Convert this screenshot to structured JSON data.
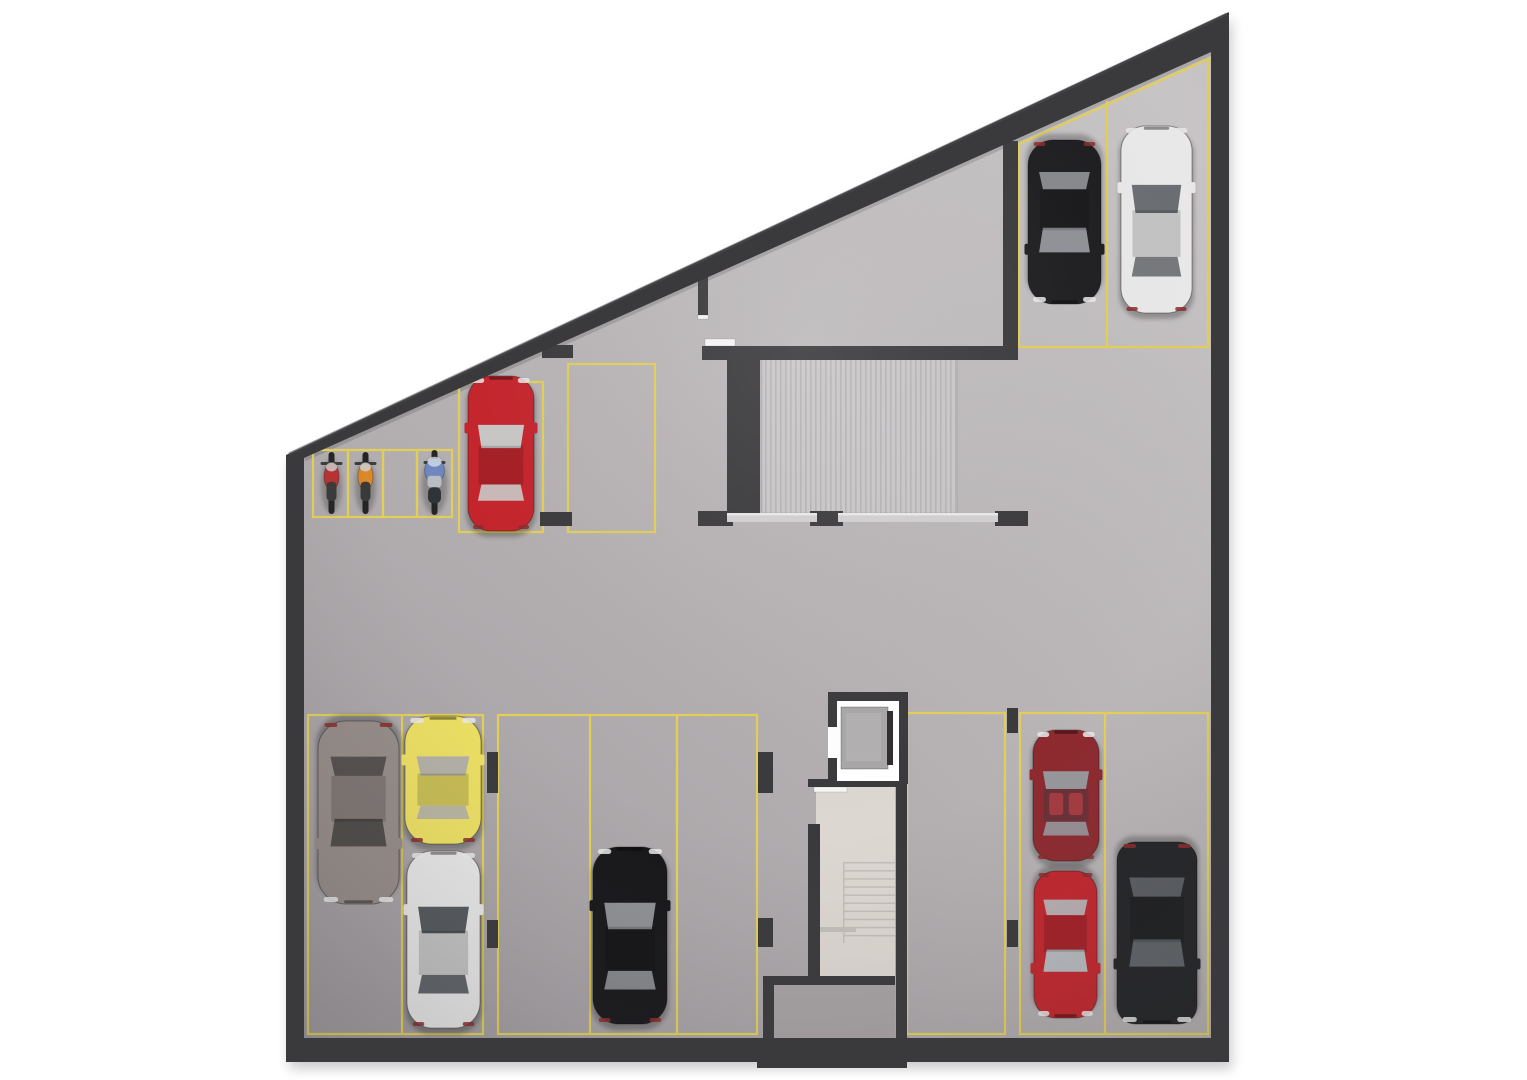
{
  "canvas": {
    "width": 1527,
    "height": 1080,
    "background": "#ffffff"
  },
  "palette": {
    "wall": "#3a3a3c",
    "wall_light": "#4b4b4d",
    "floor_light": "#c7c4c5",
    "floor_mid": "#b6b2b4",
    "floor_dark": "#a19da0",
    "stall_line": "#e3cf55",
    "ramp_base": "#c9c7c8",
    "ramp_stripe": "#b5b3b4",
    "stair_floor": "#dcd7d1",
    "stair_tread": "#c3beb8",
    "vestibule_floor": "#a7a3a5",
    "rail": "#d2d0d1",
    "rail_highlight": "#ebe9ea",
    "door": "#f5f5f5",
    "elevator_shaft": "#ffffff",
    "elevator_car": "#a9a7a7",
    "shadow": "#000000"
  },
  "building": {
    "outer": [
      [
        286,
        455
      ],
      [
        1229,
        12
      ],
      [
        1229,
        1062
      ],
      [
        286,
        1062
      ]
    ],
    "inner": [
      [
        304,
        458
      ],
      [
        1211,
        52
      ],
      [
        1211,
        1038
      ],
      [
        304,
        1038
      ]
    ]
  },
  "interior_walls": [
    {
      "name": "diagonal-stub",
      "x": 698,
      "y": 277,
      "w": 10,
      "h": 38
    },
    {
      "name": "ramp-north-wall",
      "x": 702,
      "y": 346,
      "w": 316,
      "h": 14
    },
    {
      "name": "ramp-west-wall",
      "x": 727,
      "y": 355,
      "w": 33,
      "h": 160
    },
    {
      "name": "ramp-east-wall",
      "x": 1003,
      "y": 141,
      "w": 15,
      "h": 219
    },
    {
      "name": "stall-stub-north",
      "x": 542,
      "y": 345,
      "w": 31,
      "h": 13
    },
    {
      "name": "stall-stub-south",
      "x": 540,
      "y": 512,
      "w": 32,
      "h": 14
    },
    {
      "name": "rail-post-west",
      "x": 698,
      "y": 511,
      "w": 35,
      "h": 15
    },
    {
      "name": "rail-post-mid",
      "x": 810,
      "y": 511,
      "w": 33,
      "h": 15
    },
    {
      "name": "rail-post-east",
      "x": 995,
      "y": 511,
      "w": 33,
      "h": 15
    },
    {
      "name": "pillar-a1",
      "x": 487,
      "y": 752,
      "w": 11,
      "h": 41
    },
    {
      "name": "pillar-a2",
      "x": 487,
      "y": 920,
      "w": 11,
      "h": 28
    },
    {
      "name": "pillar-b1",
      "x": 758,
      "y": 752,
      "w": 15,
      "h": 41
    },
    {
      "name": "pillar-b2",
      "x": 758,
      "y": 918,
      "w": 15,
      "h": 29
    },
    {
      "name": "pillar-c1",
      "x": 1007,
      "y": 708,
      "w": 11,
      "h": 25
    },
    {
      "name": "pillar-c2",
      "x": 1007,
      "y": 920,
      "w": 11,
      "h": 27
    },
    {
      "name": "stair-north-wall",
      "x": 808,
      "y": 779,
      "w": 99,
      "h": 8
    },
    {
      "name": "stair-west-wall",
      "x": 808,
      "y": 824,
      "w": 12,
      "h": 154
    },
    {
      "name": "stair-east-wall",
      "x": 896,
      "y": 782,
      "w": 11,
      "h": 256
    },
    {
      "name": "vestibule-north-wall",
      "x": 763,
      "y": 976,
      "w": 132,
      "h": 9
    },
    {
      "name": "vestibule-west-wall",
      "x": 763,
      "y": 976,
      "w": 11,
      "h": 62
    },
    {
      "name": "stair-south-annex",
      "x": 757,
      "y": 1038,
      "w": 150,
      "h": 30
    }
  ],
  "ramp": {
    "x": 762,
    "y": 357,
    "w": 195,
    "h": 156
  },
  "guard_rail": {
    "bars": [
      [
        727,
        513,
        90,
        9
      ],
      [
        838,
        513,
        160,
        9
      ]
    ]
  },
  "stairwell": {
    "floor": {
      "x": 816,
      "y": 787,
      "w": 79,
      "h": 191
    },
    "treads": {
      "x": 843,
      "w": 52,
      "y0": 862,
      "count": 10,
      "step": 8.1
    },
    "ledge": {
      "x": 818,
      "y": 927,
      "w": 38,
      "h": 5
    },
    "vestibule_floor": {
      "x": 774,
      "y": 985,
      "w": 121,
      "h": 53
    }
  },
  "elevator": {
    "frame": {
      "x": 828,
      "y": 692,
      "w": 80,
      "h": 92
    },
    "shaft": {
      "x": 837,
      "y": 701,
      "w": 62,
      "h": 72
    },
    "south_band": {
      "x": 837,
      "y": 771,
      "w": 62,
      "h": 10
    },
    "car": {
      "x": 841,
      "y": 707,
      "w": 47,
      "h": 62
    },
    "door_strip": {
      "x": 887,
      "y": 711,
      "w": 6,
      "h": 54
    },
    "west_gap": {
      "x": 828,
      "y": 727,
      "w": 9,
      "h": 31
    }
  },
  "doors": [
    {
      "name": "ramp-door",
      "x": 705,
      "y": 339,
      "w": 30,
      "h": 7
    },
    {
      "name": "stub-door-cap",
      "x": 698,
      "y": 315,
      "w": 10,
      "h": 4
    },
    {
      "name": "stair-door",
      "x": 814,
      "y": 787,
      "w": 33,
      "h": 5
    }
  ],
  "stalls": {
    "rects": [
      {
        "name": "moto-stall-1",
        "x": 313,
        "y": 450,
        "w": 35,
        "h": 67
      },
      {
        "name": "moto-stall-2",
        "x": 348,
        "y": 450,
        "w": 35,
        "h": 67
      },
      {
        "name": "moto-stall-3",
        "x": 383,
        "y": 450,
        "w": 34,
        "h": 67
      },
      {
        "name": "moto-stall-4",
        "x": 417,
        "y": 450,
        "w": 35,
        "h": 67
      },
      {
        "name": "stall-red-car",
        "x": 459,
        "y": 382,
        "w": 84,
        "h": 150
      },
      {
        "name": "stall-empty-upper",
        "x": 568,
        "y": 364,
        "w": 87,
        "h": 168
      },
      {
        "name": "stall-group-west",
        "x": 308,
        "y": 715,
        "w": 175,
        "h": 319
      },
      {
        "name": "stall-group-center",
        "x": 498,
        "y": 715,
        "w": 179,
        "h": 319
      },
      {
        "name": "stall-empty-column",
        "x": 677,
        "y": 715,
        "w": 80,
        "h": 319
      },
      {
        "name": "stall-empty-by-stairs",
        "x": 907,
        "y": 713,
        "w": 98,
        "h": 321
      },
      {
        "name": "stall-group-east",
        "x": 1020,
        "y": 713,
        "w": 188,
        "h": 321
      }
    ],
    "dividers": [
      [
        402,
        715,
        402,
        1034
      ],
      [
        590,
        715,
        590,
        1034
      ],
      [
        1105,
        713,
        1105,
        1034
      ],
      [
        1107,
        101,
        1107,
        347
      ]
    ],
    "upper_right_polygon": "1019,144 1019,347 1208,347 1208,59"
  },
  "vehicles": [
    {
      "kind": "moto",
      "name": "red-motorcycle",
      "x": 319,
      "y": 451,
      "w": 25,
      "h": 64,
      "body": "#b83232"
    },
    {
      "kind": "moto",
      "name": "orange-motorcycle",
      "x": 353,
      "y": 451,
      "w": 25,
      "h": 64,
      "body": "#d9882a"
    },
    {
      "kind": "scooter",
      "name": "blue-scooter",
      "x": 420,
      "y": 449,
      "w": 29,
      "h": 67,
      "body": "#6e87c0"
    },
    {
      "kind": "car",
      "name": "red-hatchback",
      "x": 466,
      "y": 376,
      "w": 70,
      "h": 155,
      "facing": "up",
      "body": "#c5232b",
      "glass": "#c9c7c5"
    },
    {
      "kind": "car",
      "name": "black-sedan-upper",
      "x": 1026,
      "y": 140,
      "w": 77,
      "h": 164,
      "facing": "down",
      "body": "#1d1d20",
      "glass": "#8f9196"
    },
    {
      "kind": "car",
      "name": "white-sedan-upper",
      "x": 1119,
      "y": 126,
      "w": 75,
      "h": 187,
      "facing": "up",
      "body": "#e9e9e9",
      "glass": "#6a6e72"
    },
    {
      "kind": "car",
      "name": "gray-luxury-sedan",
      "x": 316,
      "y": 721,
      "w": 85,
      "h": 183,
      "facing": "down",
      "body": "#958c88",
      "glass": "#4e4a48"
    },
    {
      "kind": "car",
      "name": "yellow-compact",
      "x": 403,
      "y": 716,
      "w": 80,
      "h": 128,
      "facing": "up",
      "body": "#ecdf63",
      "glass": "#b3b0a6"
    },
    {
      "kind": "car",
      "name": "white-sedan-lower",
      "x": 405,
      "y": 851,
      "w": 77,
      "h": 177,
      "facing": "up",
      "body": "#e6e6e6",
      "glass": "#53575b"
    },
    {
      "kind": "car",
      "name": "black-sedan-lower",
      "x": 591,
      "y": 847,
      "w": 78,
      "h": 177,
      "facing": "up",
      "body": "#17171a",
      "glass": "#8e9094"
    },
    {
      "kind": "car",
      "name": "maroon-coupe",
      "x": 1031,
      "y": 730,
      "w": 70,
      "h": 131,
      "facing": "up",
      "body": "#8c2a30",
      "glass": "#96969b",
      "roof": "#6a3036"
    },
    {
      "kind": "car",
      "name": "red-sedan-lower",
      "x": 1032,
      "y": 871,
      "w": 67,
      "h": 147,
      "facing": "down",
      "body": "#c0262d",
      "glass": "#b6b9bd"
    },
    {
      "kind": "car",
      "name": "black-suv",
      "x": 1115,
      "y": 842,
      "w": 84,
      "h": 182,
      "facing": "down",
      "body": "#232427",
      "glass": "#5e6266",
      "suv": true
    }
  ]
}
